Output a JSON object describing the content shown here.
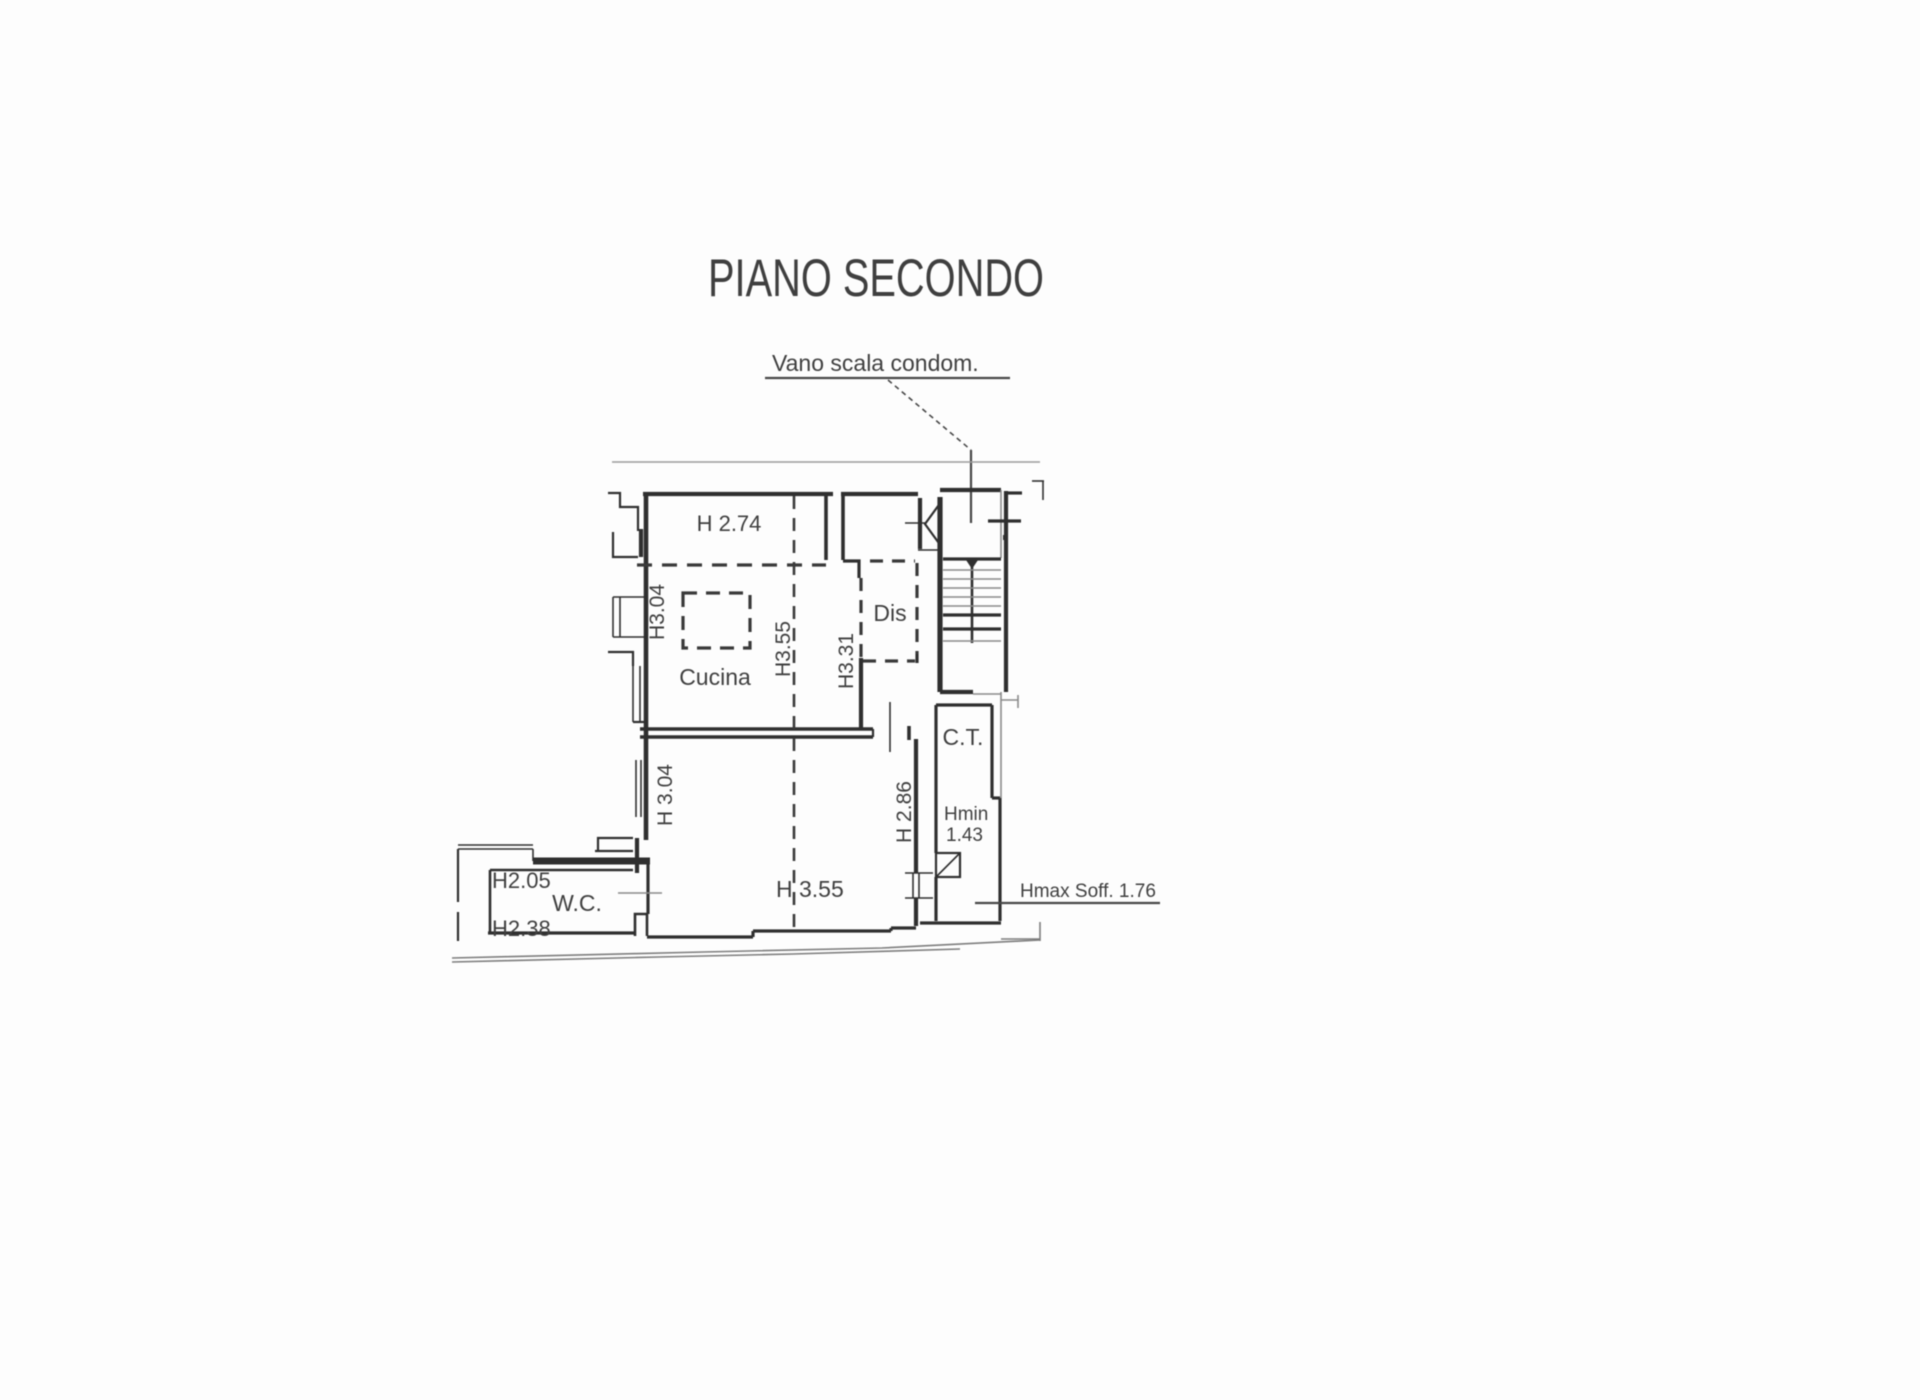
{
  "page": {
    "title": "PIANO SECONDO"
  },
  "callout": {
    "text": "Vano scala condom."
  },
  "rooms": {
    "cucina": "Cucina",
    "dis": "Dis",
    "ct": "C.T.",
    "wc": "W.C."
  },
  "heights": {
    "top_room": "H 2.74",
    "kitchen_left": "H3.04",
    "center": "H3.55",
    "hall": "H3.31",
    "living_left": "H 3.04",
    "living_right": "H 2.86",
    "living_bottom": "H 3.55",
    "wc_top": "H2.05",
    "wc_bottom": "H2.38",
    "ct_min_label": "Hmin",
    "ct_min_value": "1.43",
    "ceiling_max": "Hmax Soff. 1.76"
  },
  "colors": {
    "wall": "#2f2f2f",
    "thin": "#8a8a8a",
    "outline": "#7d7d7d",
    "ref": "#9c9c9c",
    "text": "#3f3f3f",
    "bg": "#fdfdfd",
    "dash": "#3a3a3a",
    "callout": "#474747"
  }
}
